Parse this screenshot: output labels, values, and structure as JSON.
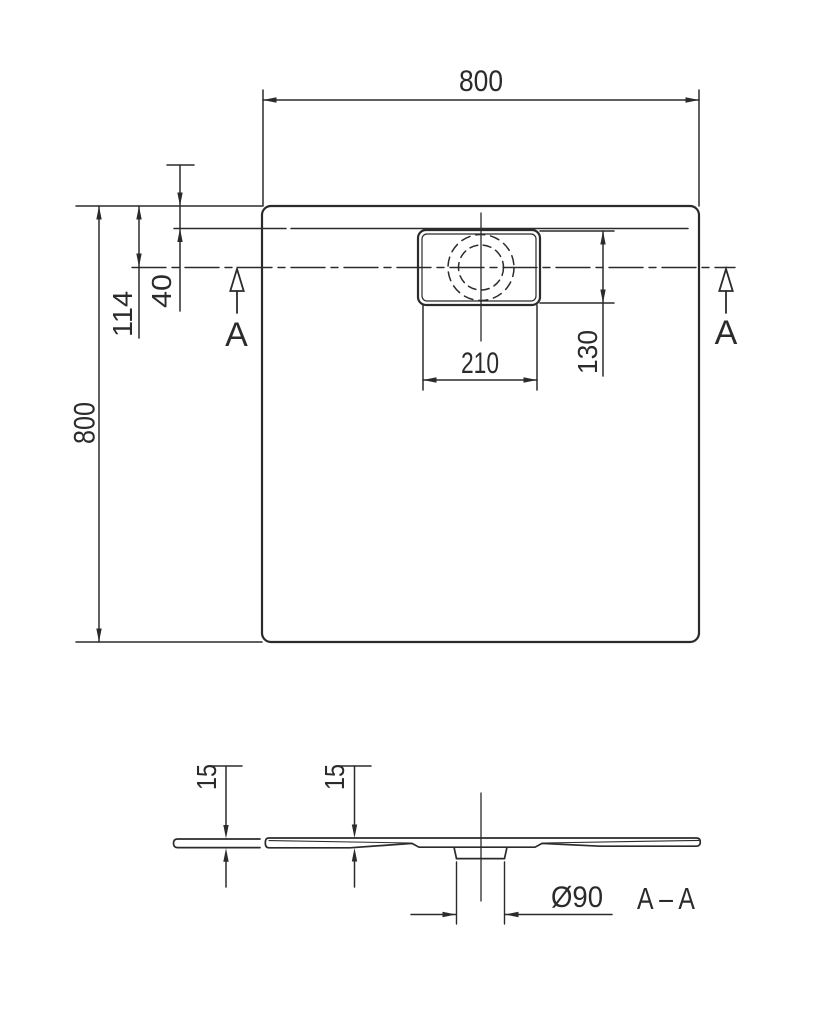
{
  "colors": {
    "line": "#2b2b2b",
    "background": "#ffffff"
  },
  "plan_view": {
    "overall_width": "800",
    "overall_depth": "800",
    "edge_to_drain_center": "114",
    "rim_to_inner_surface": "40",
    "drain_cover_width": "210",
    "drain_center_offset": "130",
    "section_marker_left": "A",
    "section_marker_right": "A"
  },
  "section_view": {
    "edge_thickness": "15",
    "inner_thickness": "15",
    "drain_outlet_diameter": "Ø90",
    "section_label": "A – A"
  }
}
